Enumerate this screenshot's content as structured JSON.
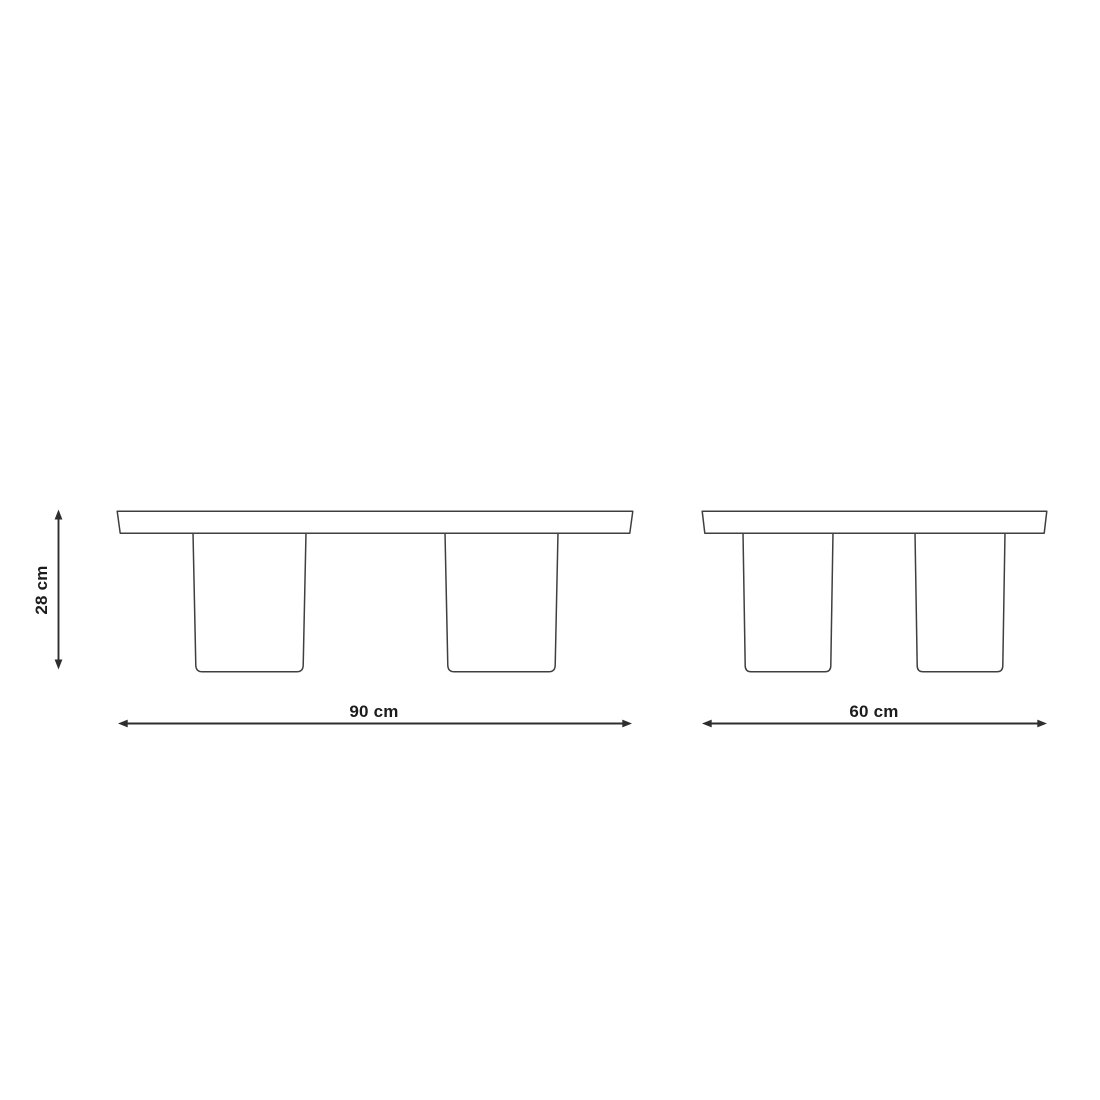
{
  "page": {
    "background": "#ffffff"
  },
  "colors": {
    "outline": "#3f3f3f",
    "dimension": "#2e2e2e",
    "text": "#1c1c1c"
  },
  "diagram": {
    "height_label": "28 cm",
    "tables": [
      {
        "id": "table-90",
        "width_label": "90 cm"
      },
      {
        "id": "table-60",
        "width_label": "60 cm"
      }
    ]
  }
}
